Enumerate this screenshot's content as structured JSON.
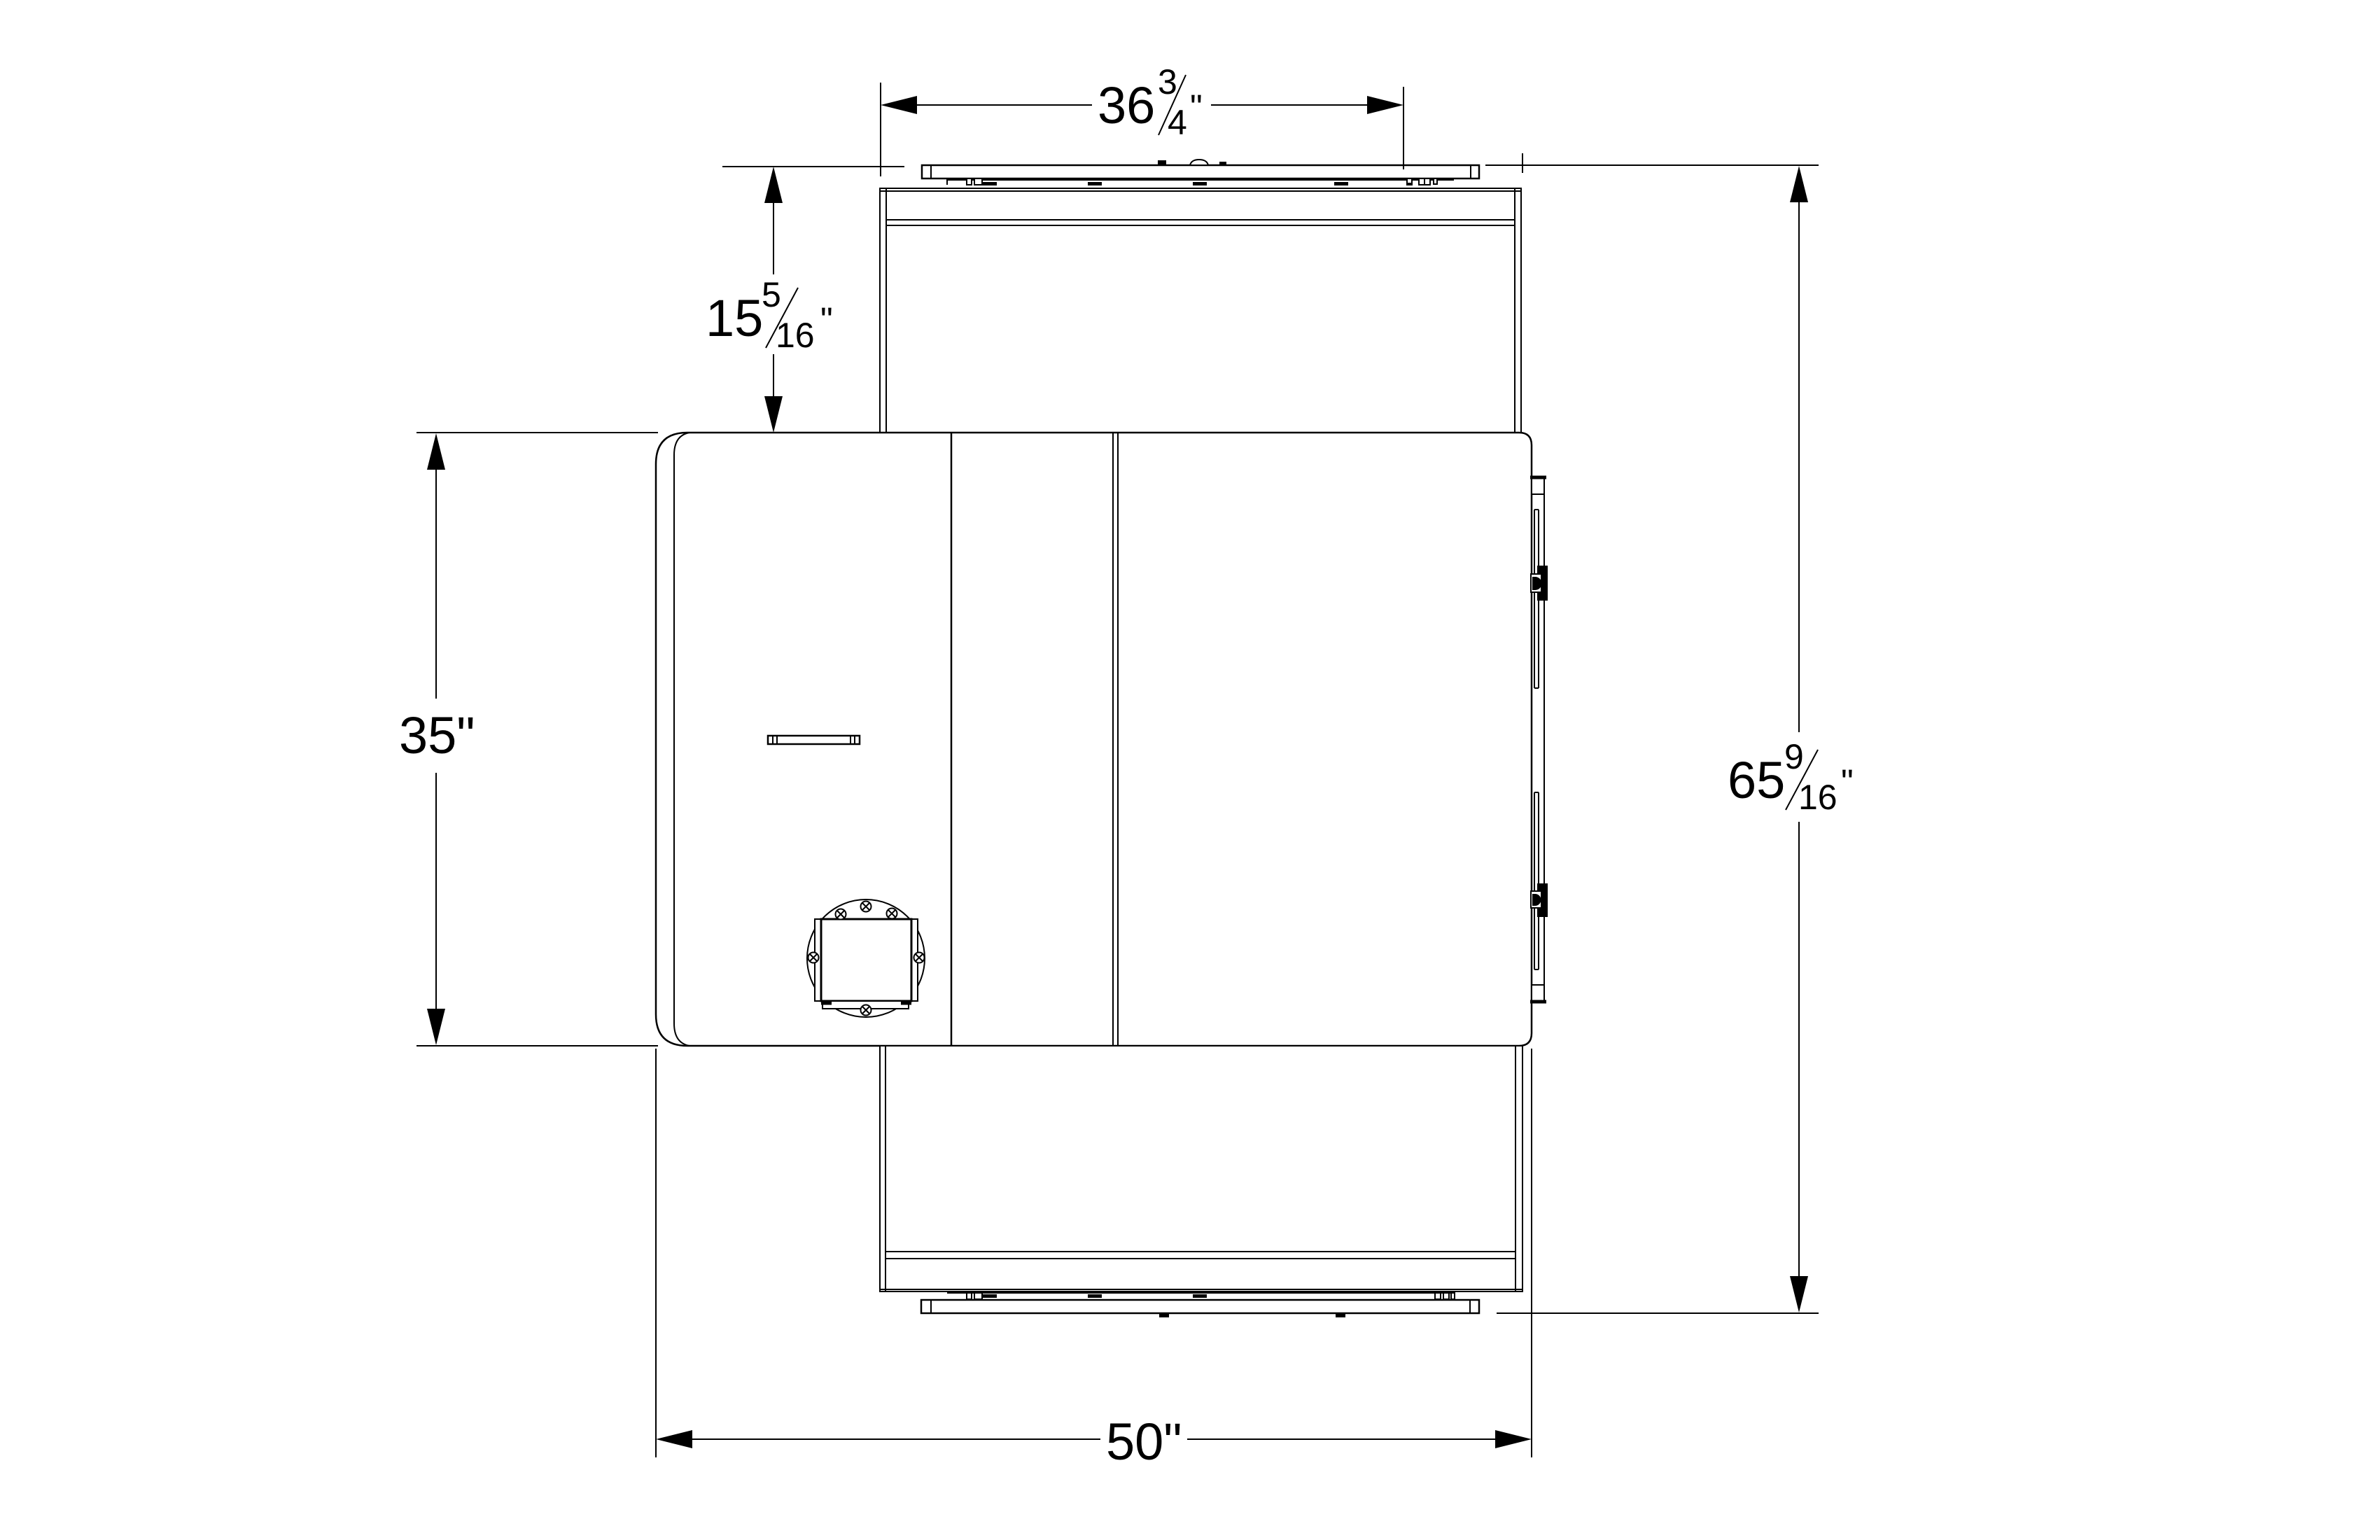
{
  "page": {
    "background": "#ffffff",
    "line_color": "#000000"
  },
  "dimensions": {
    "top_width": {
      "whole": "36",
      "numerator": "3",
      "denominator": "4",
      "unit": "\""
    },
    "upper_depth": {
      "whole": "15",
      "numerator": "5",
      "denominator": "16",
      "unit": "\""
    },
    "body_depth": {
      "label": "35\""
    },
    "overall_length": {
      "whole": "65",
      "numerator": "9",
      "denominator": "16",
      "unit": "\""
    },
    "body_width": {
      "label": "50\""
    }
  }
}
